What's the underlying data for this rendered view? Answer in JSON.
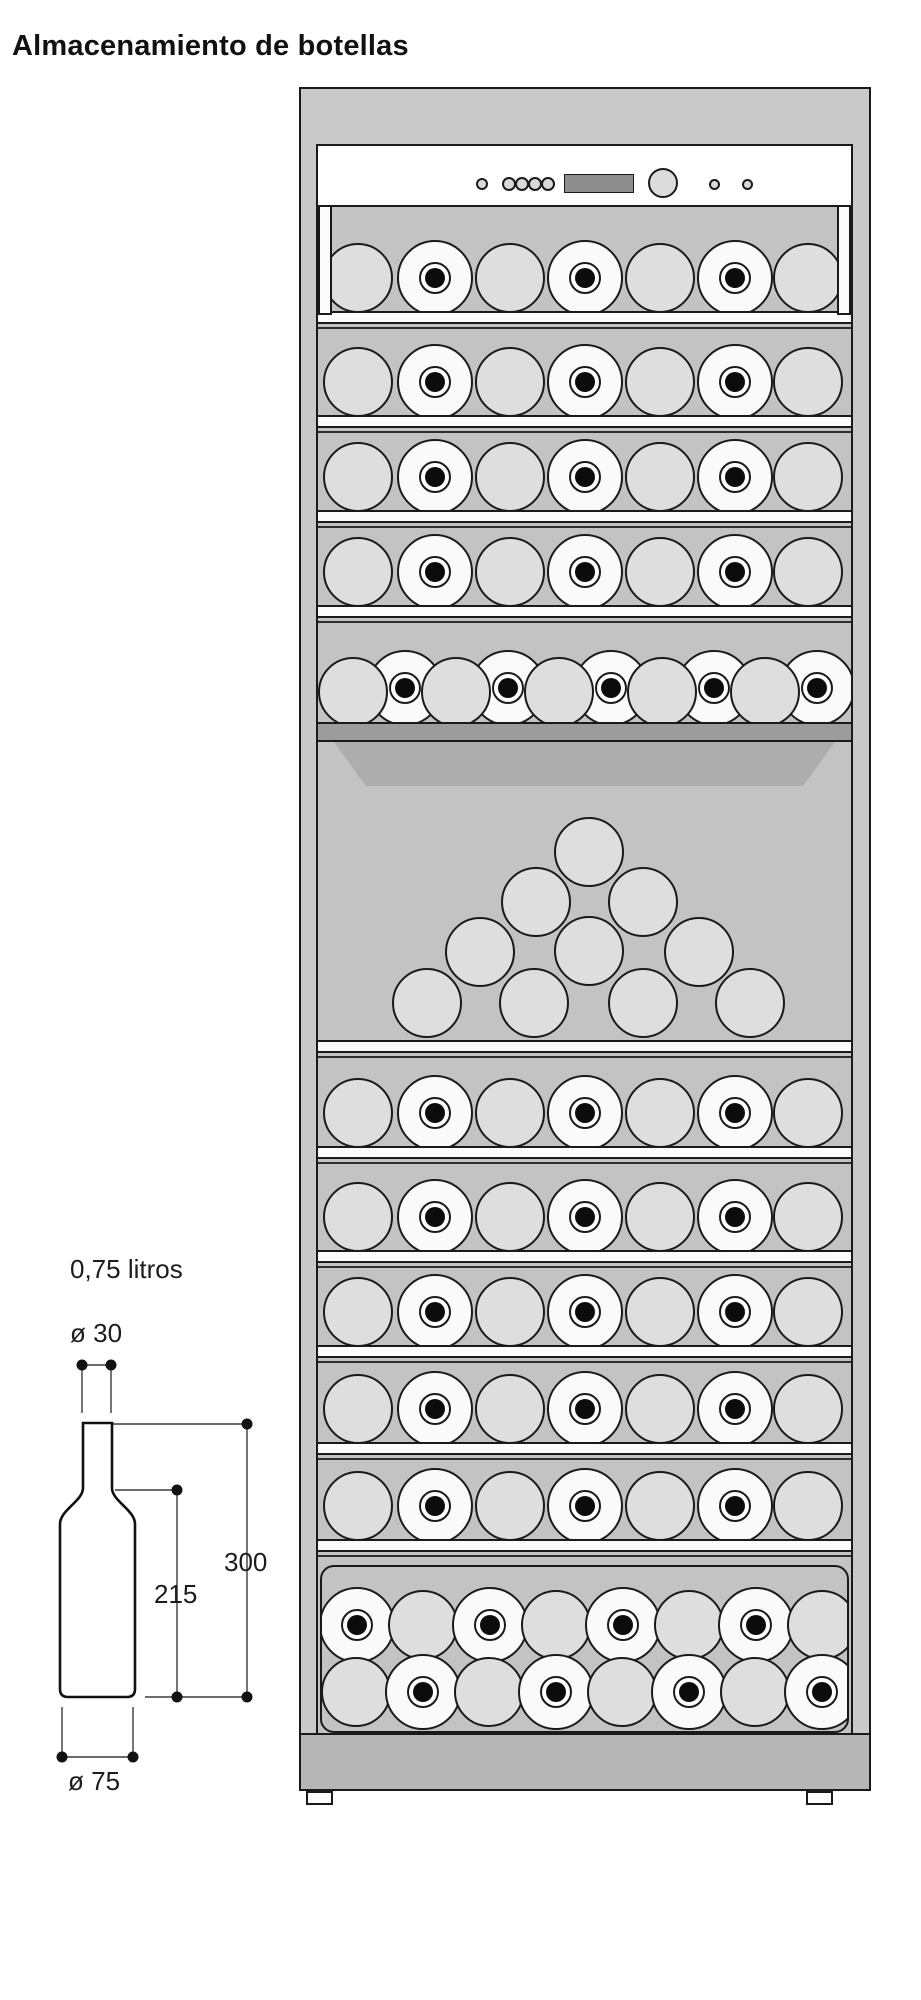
{
  "title": "Almacenamiento de botellas",
  "dimension_diagram": {
    "volume_label": "0,75 litros",
    "neck_diameter_label": "ø 30",
    "total_height_label": "300",
    "body_height_label": "215",
    "body_diameter_label": "ø 75"
  },
  "colors": {
    "frame": "#c9c9c9",
    "interior": "#c3c3c3",
    "bottle_plain": "#dedede",
    "bottle_neck": "#fafafa",
    "shelf": "#fcfcfc",
    "presentation_bar": "#9c9c9c",
    "presentation_front": "#adadad",
    "base": "#b6b6b6",
    "display": "#8e8e8e",
    "knob": "#dcdcdc",
    "led": "#d9d9d9",
    "line": "#1a1a1a"
  },
  "cabinet": {
    "panel": {
      "controls": [
        "power-led",
        "button-group-4",
        "temperature-display",
        "control-knob",
        "indicator-led-1",
        "indicator-led-2"
      ]
    },
    "standard_row_x": [
      358,
      435,
      510,
      585,
      660,
      735,
      808
    ],
    "standard_row_pattern": [
      "plain",
      "neck",
      "plain",
      "neck",
      "plain",
      "neck",
      "plain"
    ],
    "standard_rows_y": [
      278,
      382,
      477,
      572,
      1113,
      1217,
      1312,
      1409,
      1506
    ],
    "shelves_y": [
      311,
      415,
      510,
      605,
      1040,
      1146,
      1250,
      1345,
      1442,
      1539
    ],
    "staggered_row": {
      "neck_x": [
        405,
        508,
        611,
        714,
        817
      ],
      "neck_y": 688,
      "plain_x": [
        353,
        456,
        559,
        662,
        765
      ],
      "plain_y": 692
    },
    "presentation_shelf": {
      "bar_y": 722,
      "front_y": 742
    },
    "pyramid": [
      [
        589,
        852
      ],
      [
        536,
        902
      ],
      [
        643,
        902
      ],
      [
        480,
        952
      ],
      [
        589,
        951
      ],
      [
        699,
        952
      ],
      [
        427,
        1003
      ],
      [
        534,
        1003
      ],
      [
        643,
        1003
      ],
      [
        750,
        1003
      ]
    ],
    "tray": {
      "top_row": {
        "y": 1625,
        "bottles": [
          {
            "x": 357,
            "kind": "neck"
          },
          {
            "x": 423,
            "kind": "plain"
          },
          {
            "x": 490,
            "kind": "neck"
          },
          {
            "x": 556,
            "kind": "plain"
          },
          {
            "x": 623,
            "kind": "neck"
          },
          {
            "x": 689,
            "kind": "plain"
          },
          {
            "x": 756,
            "kind": "neck"
          },
          {
            "x": 822,
            "kind": "plain"
          }
        ]
      },
      "bottom_row": {
        "y": 1692,
        "bottles": [
          {
            "x": 356,
            "kind": "plain"
          },
          {
            "x": 423,
            "kind": "neck"
          },
          {
            "x": 489,
            "kind": "plain"
          },
          {
            "x": 556,
            "kind": "neck"
          },
          {
            "x": 622,
            "kind": "plain"
          },
          {
            "x": 689,
            "kind": "neck"
          },
          {
            "x": 755,
            "kind": "plain"
          },
          {
            "x": 822,
            "kind": "neck"
          }
        ]
      }
    }
  }
}
